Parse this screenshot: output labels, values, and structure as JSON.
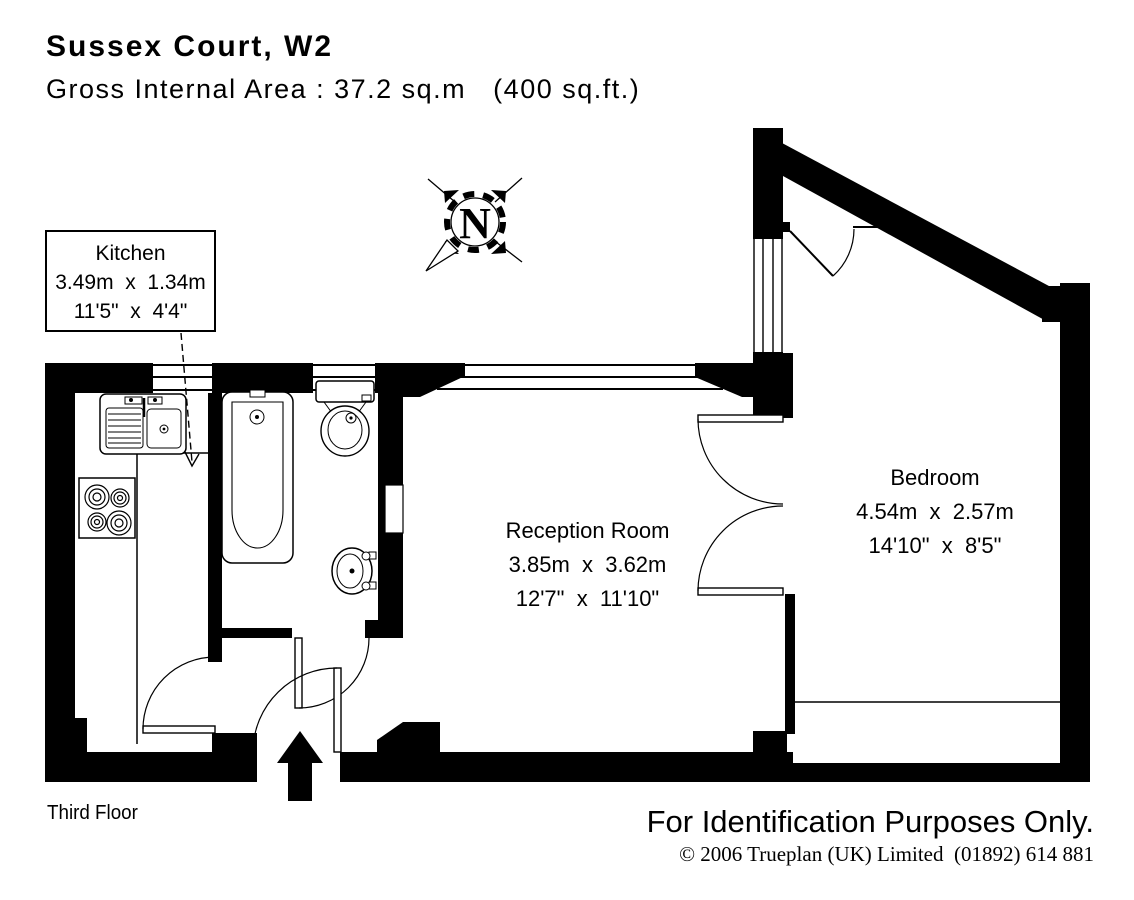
{
  "header": {
    "title": "Sussex Court, W2",
    "area_line": "Gross Internal Area : 37.2 sq.m   (400 sq.ft.)"
  },
  "rooms": {
    "kitchen": {
      "name": "Kitchen",
      "metric": "3.49m  x  1.34m",
      "imperial": "11'5\"  x  4'4\""
    },
    "reception": {
      "name": "Reception Room",
      "metric": "3.85m  x  3.62m",
      "imperial": "12'7\"  x  11'10\""
    },
    "bedroom": {
      "name": "Bedroom",
      "metric": "4.54m  x  2.57m",
      "imperial": "14'10\"  x  8'5\""
    }
  },
  "compass": {
    "letter": "N"
  },
  "floor_label": "Third Floor",
  "footer": {
    "disclaimer": "For Identification Purposes Only.",
    "copyright": "© 2006 Trueplan (UK) Limited  (01892) 614 881"
  },
  "colors": {
    "ink": "#000000",
    "paper": "#ffffff"
  }
}
